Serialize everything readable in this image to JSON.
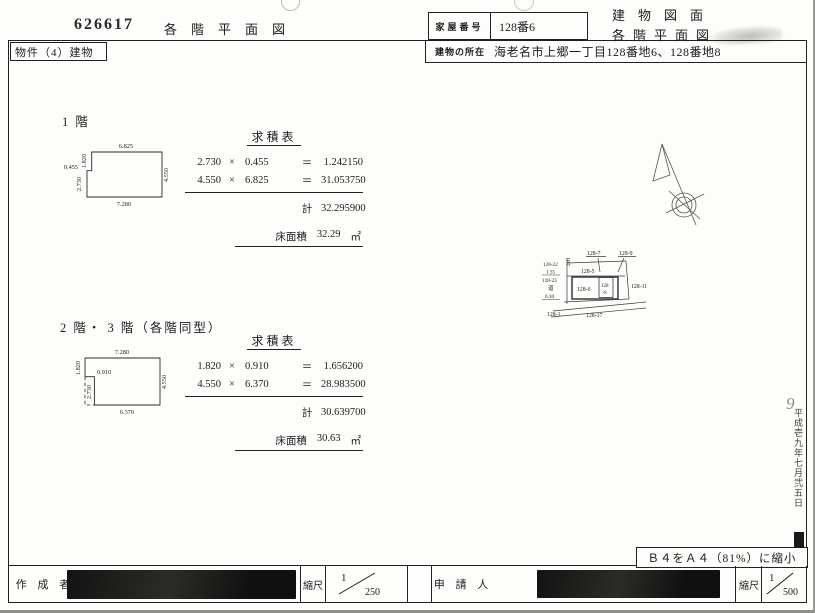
{
  "header": {
    "doc_number": "626617",
    "left_title": "各階平面図",
    "house_number_label": "家屋番号",
    "house_number_value": "128番6",
    "title_line1": "建物図面",
    "title_line2": "各階平面図",
    "property_label": "物件（4）建物",
    "location_label": "建物の所在",
    "location_value": "海老名市上郷一丁目128番地6、128番地8"
  },
  "floor1": {
    "section_label": "1 階",
    "table_title": "求積表",
    "rows": [
      {
        "a": "2.730",
        "op": "×",
        "b": "0.455",
        "eq": "＝",
        "result": "1.242150"
      },
      {
        "a": "4.550",
        "op": "×",
        "b": "6.825",
        "eq": "＝",
        "result": "31.053750"
      }
    ],
    "total_label": "計",
    "total_value": "32.295900",
    "area_label": "床面積",
    "area_value": "32.29",
    "area_unit": "㎡",
    "dims": {
      "top": "6.825",
      "bottom": "7.280",
      "right": "4.550",
      "left_upper": "1.820",
      "step": "0.455",
      "left_lower": "2.730"
    }
  },
  "floor23": {
    "section_label": "2 階・ 3 階（各階同型）",
    "table_title": "求積表",
    "rows": [
      {
        "a": "1.820",
        "op": "×",
        "b": "0.910",
        "eq": "＝",
        "result": "1.656200"
      },
      {
        "a": "4.550",
        "op": "×",
        "b": "6.370",
        "eq": "＝",
        "result": "28.983500"
      }
    ],
    "total_label": "計",
    "total_value": "30.639700",
    "area_label": "床面積",
    "area_value": "30.63",
    "area_unit": "㎡",
    "dims": {
      "top": "7.280",
      "bottom": "6.370",
      "right": "4.550",
      "left_upper": "1.820",
      "step": "0.910",
      "left_lower": "2.730"
    }
  },
  "site_map": {
    "p7": "128-7",
    "p9": "128-9",
    "p5": "128-5",
    "p22": "128-22",
    "d135": "1.35",
    "p23": "128-23",
    "road": "道",
    "d030": "0.30",
    "p6": "128-6",
    "p8_line1": "128",
    "p8_line2": "-8",
    "p11": "128-11",
    "p1": "128-1",
    "p17": "128-17",
    "dim_small": "2.01"
  },
  "notes": {
    "reduction": "Ｂ４をＡ４（81%）に縮小"
  },
  "footer": {
    "creator_label": "作 成 者",
    "scale_label_left": "縮尺",
    "scale1_num": "1",
    "scale1_den": "250",
    "applicant_label": "申 請 人",
    "scale_label_right": "縮尺",
    "scale2_num": "1",
    "scale2_den": "500"
  },
  "side": {
    "date_note": "平成壱九年七月弐五日",
    "pen_mark": "9"
  }
}
